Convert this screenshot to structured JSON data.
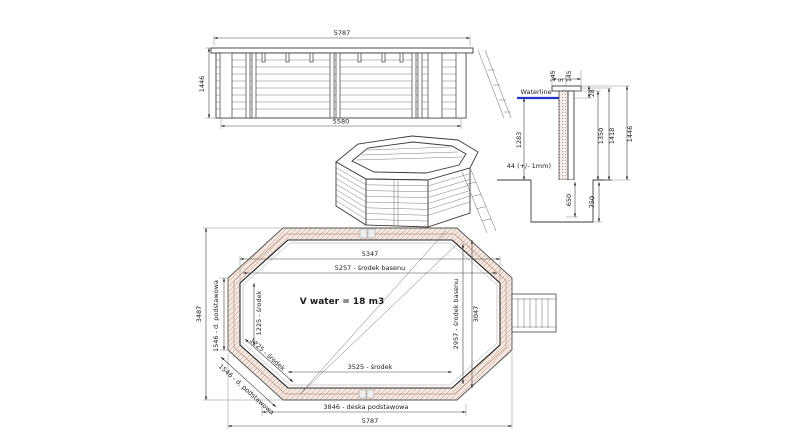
{
  "elevation": {
    "width_top": "5787",
    "width_bottom": "5580",
    "height": "1446"
  },
  "section": {
    "cap_left": "145",
    "cap_gap": "5",
    "cap_right": "145",
    "waterline_label": "Waterline",
    "top_to_waterline": "28",
    "water_depth": "1283",
    "height_inner": "1350",
    "height_mid": "1418",
    "height_total": "1446",
    "wall_note": "44 (+/- 1mm)",
    "embed_depth": "650",
    "trench_depth": "750"
  },
  "plan": {
    "volume_note": "V water = 18 m3",
    "inner_width": "5347",
    "center_width": "5257 - środek basenu",
    "inner_length": "3047",
    "center_length": "2957 - środek basenu",
    "overall_width": "5787",
    "overall_height": "3487",
    "side_board": "1546 - d. podstawowa",
    "side_center": "1225 - środek",
    "diag_center": "1225 - środek",
    "diag_board": "1546 - d. podstawowa",
    "bottom_center": "3525 - środek",
    "base_board": "3846 - deska podstawowa"
  },
  "colors": {
    "waterline": "#2233cc",
    "wood_hatch": "#cfa79b",
    "line": "#3a3a3a"
  }
}
